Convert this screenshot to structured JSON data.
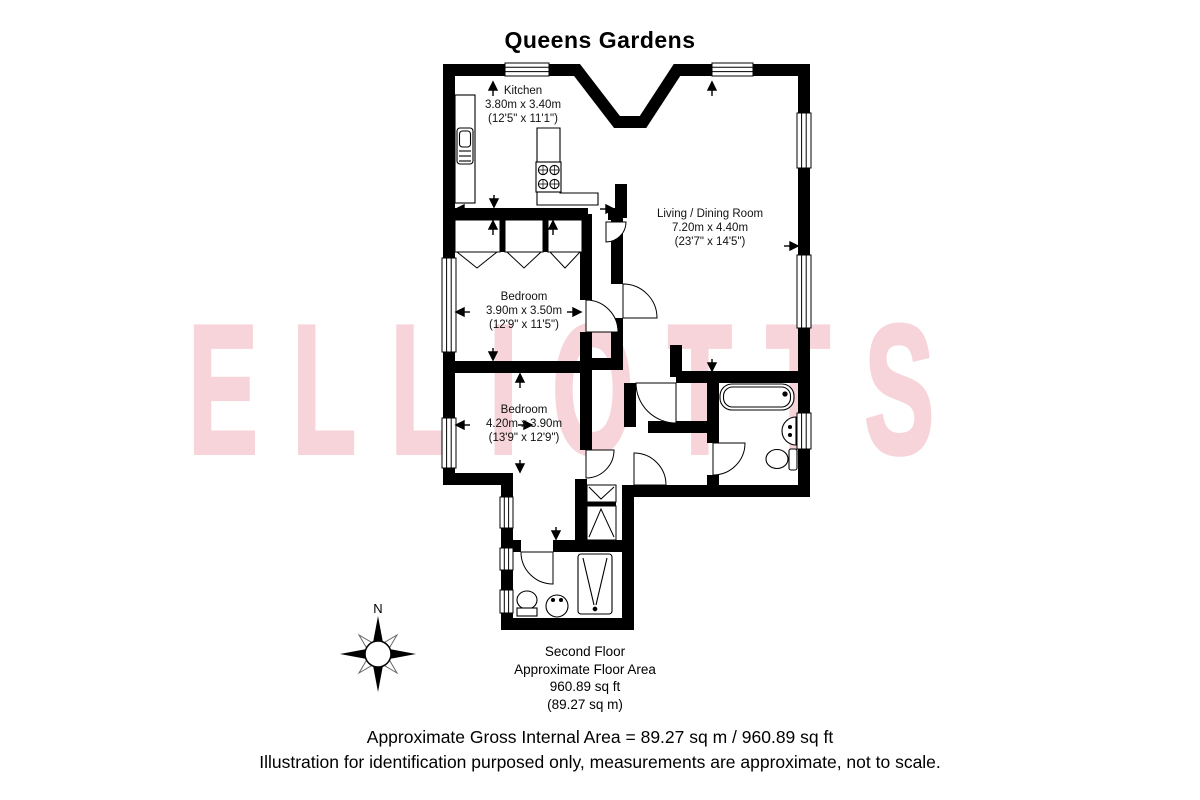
{
  "page": {
    "title": "Queens Gardens"
  },
  "watermark": {
    "text": "ELLIOTTS",
    "color": "#f7d4d9"
  },
  "compass": {
    "north_label": "N"
  },
  "rooms": {
    "kitchen": {
      "name": "Kitchen",
      "metric": "3.80m x 3.40m",
      "imperial": "(12'5\" x 11'1\")"
    },
    "living": {
      "name": "Living / Dining Room",
      "metric": "7.20m x 4.40m",
      "imperial": "(23'7\" x 14'5\")"
    },
    "bedroom1": {
      "name": "Bedroom",
      "metric": "3.90m x 3.50m",
      "imperial": "(12'9\" x 11'5\")"
    },
    "bedroom2": {
      "name": "Bedroom",
      "metric": "4.20m x 3.90m",
      "imperial": "(13'9\" x 12'9\")"
    }
  },
  "floor_summary": {
    "floor": "Second Floor",
    "area_label": "Approximate Floor Area",
    "area_ft": "960.89 sq ft",
    "area_m": "(89.27 sq m)"
  },
  "footer": {
    "line1": "Approximate Gross Internal Area = 89.27 sq m / 960.89 sq ft",
    "line2": "Illustration for identification purposed only, measurements are approximate, not to scale."
  },
  "colors": {
    "wall": "#000000",
    "watermark_pink": "#f7d4d9"
  }
}
